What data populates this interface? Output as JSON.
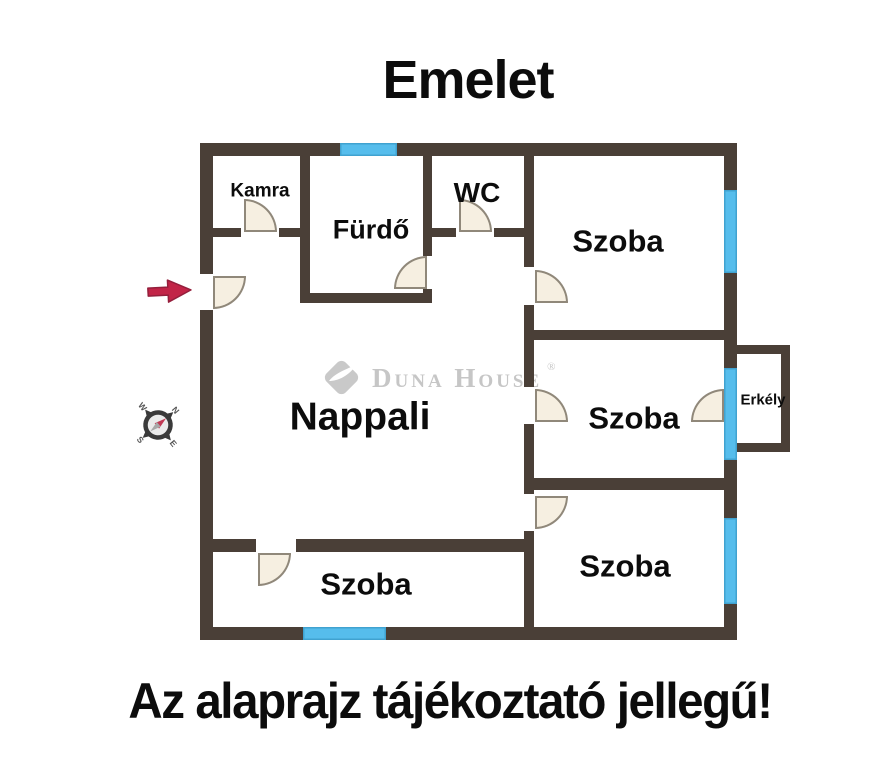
{
  "title": "Emelet",
  "footer": "Az alaprajz tájékoztató jellegű!",
  "watermark": {
    "brand": "Duna House",
    "registered": "®"
  },
  "rooms": {
    "kamra": "Kamra",
    "furdo": "Fürdő",
    "wc": "WC",
    "szoba_top": "Szoba",
    "szoba_middle": "Szoba",
    "szoba_bottom_right": "Szoba",
    "szoba_bottom_left": "Szoba",
    "nappali": "Nappali",
    "erkely": "Erkély"
  },
  "compass": {
    "n": "N",
    "e": "E",
    "s": "S",
    "w": "W"
  },
  "colors": {
    "wall": "#4a3f37",
    "window": "#56bdec",
    "door_fill": "#f6efe1",
    "door_border": "#90887a",
    "entrance_arrow": "#c22447",
    "watermark": "#c6c6c6",
    "text": "#0c0c0c"
  }
}
